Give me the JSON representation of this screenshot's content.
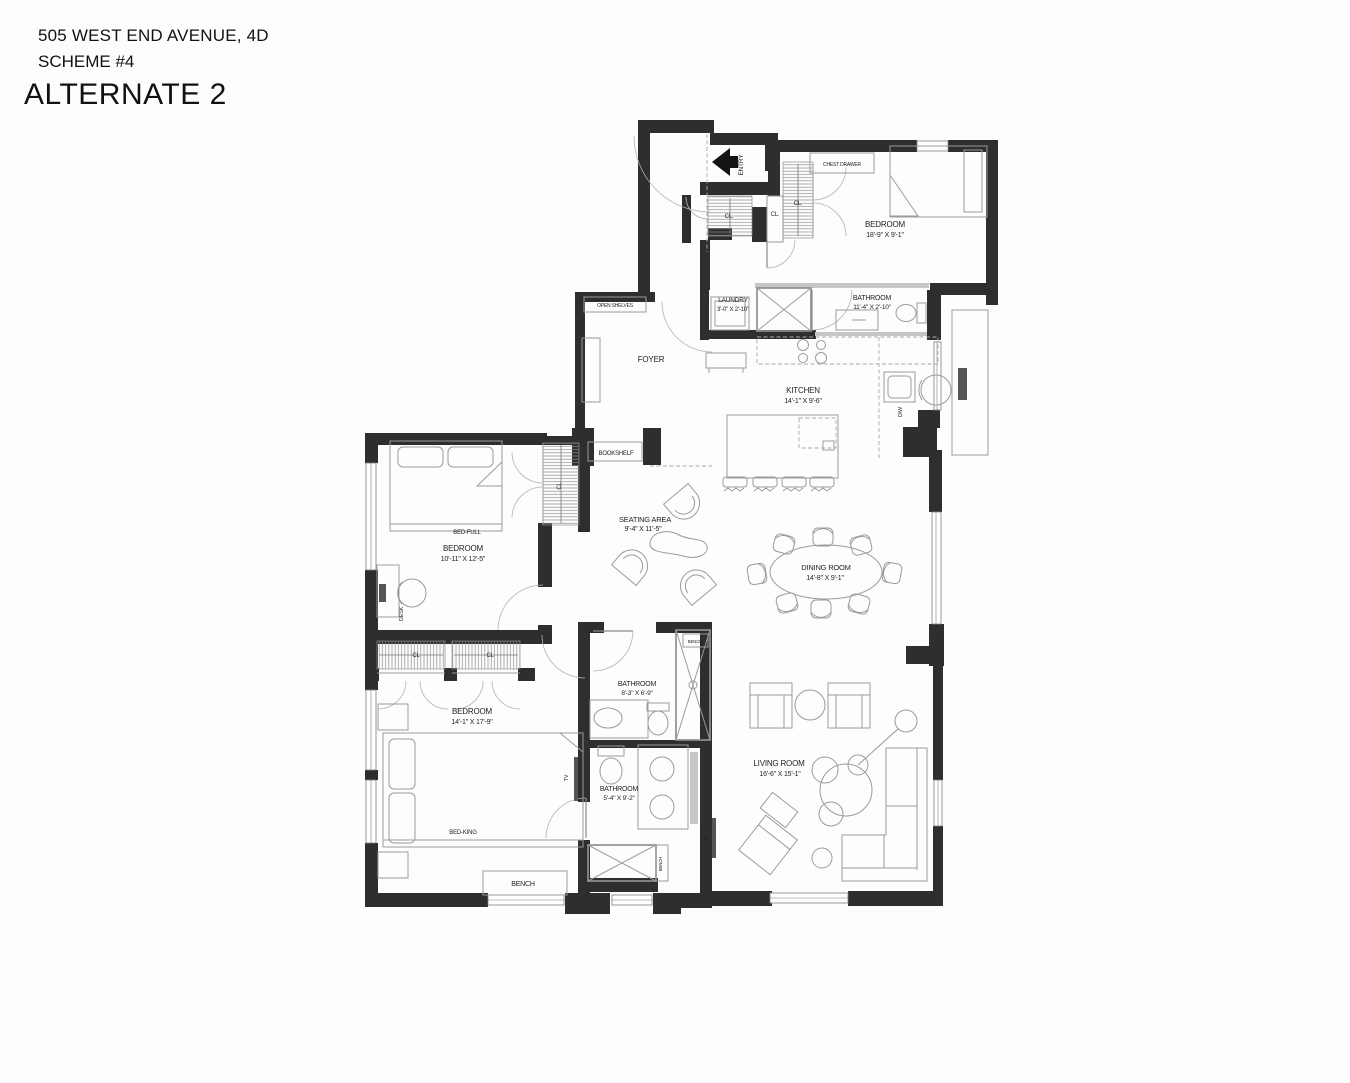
{
  "header": {
    "address": "505 WEST END AVENUE, 4D",
    "scheme": "SCHEME #4",
    "title": "ALTERNATE 2"
  },
  "rooms": {
    "bedroom_guest": {
      "name": "BEDROOM",
      "dims": "18'-9\" X 9'-1\""
    },
    "bathroom_hall": {
      "name": "BATHROOM",
      "dims": "11'-4\" X 2'-10\""
    },
    "laundry": {
      "name": "LAUNDRY",
      "dims": "3'-0\" X 2'-10\""
    },
    "kitchen": {
      "name": "KITCHEN",
      "dims": "14'-1\" X 9'-6\""
    },
    "foyer": {
      "name": "FOYER"
    },
    "seating_area": {
      "name": "SEATING AREA",
      "dims": "9'-4\" X 11'-5\""
    },
    "dining_room": {
      "name": "DINING ROOM",
      "dims": "14'-8\" X 9'-1\""
    },
    "bedroom_middle": {
      "name": "BEDROOM",
      "dims": "10'-11\" X 12'-5\""
    },
    "bedroom_master": {
      "name": "BEDROOM",
      "dims": "14'-1\" X 17'-9\""
    },
    "bathroom_middle": {
      "name": "BATHROOM",
      "dims": "8'-3\" X 6'-9\""
    },
    "bathroom_master": {
      "name": "BATHROOM",
      "dims": "5'-4\" X 9'-2\""
    },
    "living_room": {
      "name": "LIVING ROOM",
      "dims": "16'-6\" X 15'-1\""
    }
  },
  "labels": {
    "entry": "ENTRY",
    "closet": "CL.",
    "closet_plain": "CL",
    "chest_drawer": "CHEST DRAWER",
    "open_shelves": "OPEN SHELVES",
    "bookshelf": "BOOKSHELF",
    "bed_full": "BED-FULL",
    "bed_king": "BED-KING",
    "desk": "DESK",
    "bench": "BENCH",
    "tv": "TV",
    "dishwasher": "D/W"
  },
  "colors": {
    "wall": "#2e2e2e",
    "furniture_line": "#9b9b9b",
    "text": "#1f1f1f"
  }
}
